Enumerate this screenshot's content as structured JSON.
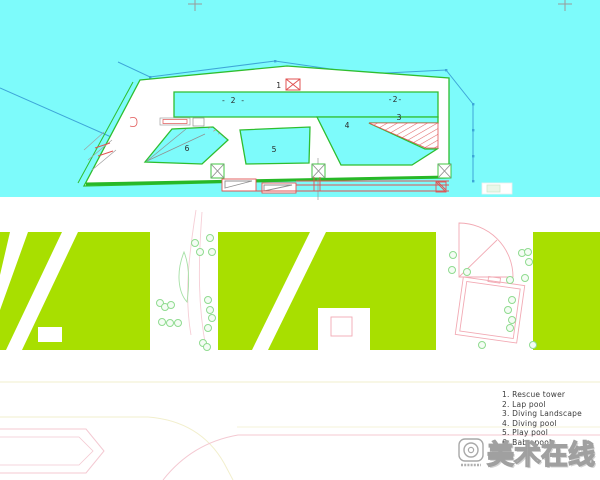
{
  "plan": {
    "pool_labels": {
      "rescue_tower_num": "1",
      "lap_pool_left": "- 2 -",
      "lap_pool_right": "-2-",
      "diving_landscape_num": "3",
      "diving_pool_num": "4",
      "play_pool_num": "5",
      "baby_pool_num": "6"
    }
  },
  "legend": {
    "items": [
      "1. Rescue tower",
      "2. Lap pool",
      "3. Diving Landscape",
      "4. Diving pool",
      "5. Play pool",
      "6. Baby pool"
    ]
  },
  "watermark": {
    "text": "美术在线"
  },
  "colors": {
    "water_cyan": "#7dfbfb",
    "pool_outline_green": "#2fbe2f",
    "landscape_lime": "#a8df00",
    "annotation_red": "#e05353",
    "boundary_blue": "#3ea6d8",
    "road_pink": "#f4c9d2",
    "road_yellow": "#f2efcd",
    "building_pink": "#f2aab4"
  }
}
